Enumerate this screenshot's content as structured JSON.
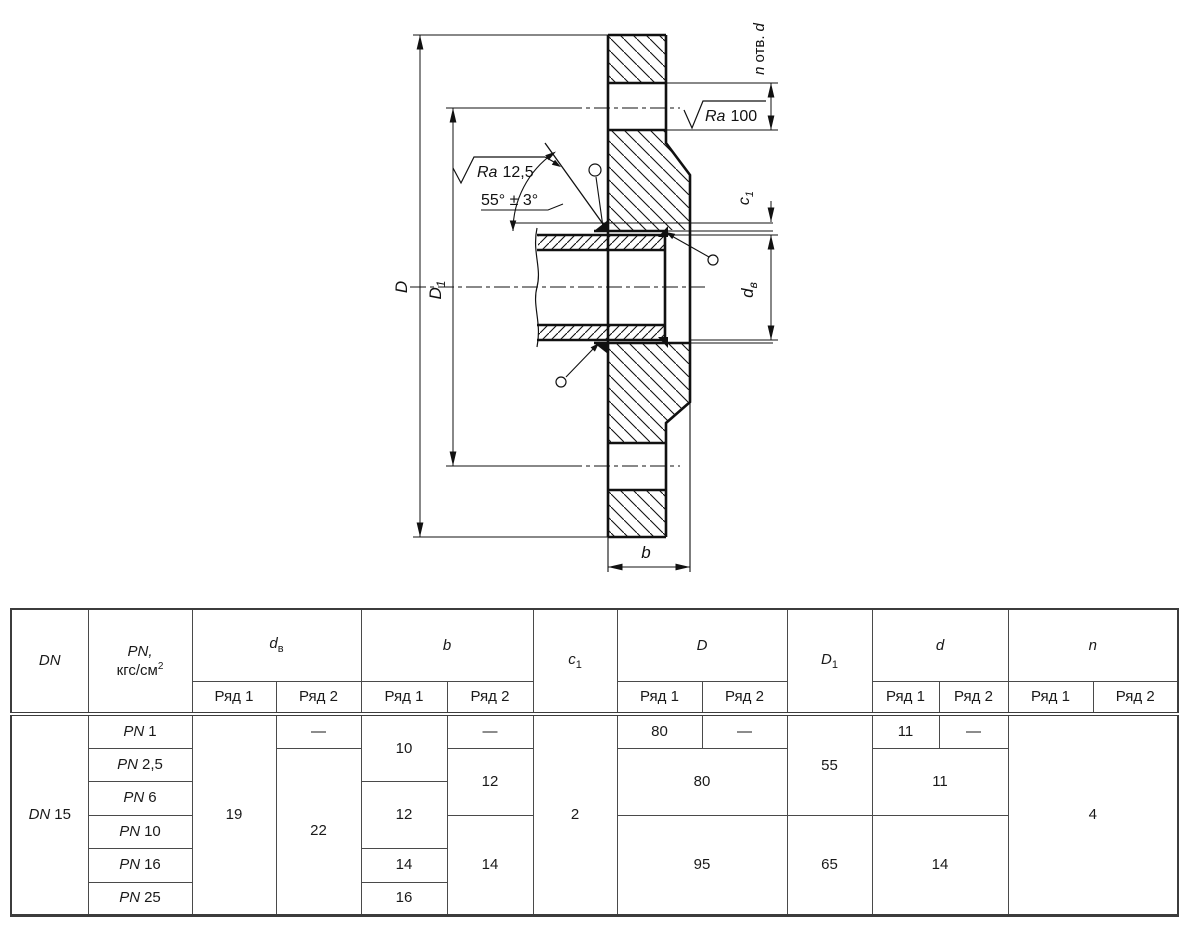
{
  "drawing": {
    "labels": {
      "D": "D",
      "D1_base": "D",
      "D1_sub": "1",
      "dv_base": "d",
      "dv_sub": "в",
      "c1_base": "c",
      "c1_sub": "1",
      "b": "b",
      "n_otv_prefix": "n",
      "n_otv_mid": "отв.",
      "n_otv_suffix": "d",
      "angle": "55° ± 3°",
      "ra_face_prefix": "Ra",
      "ra_face_value": "12,5",
      "ra_holes_prefix": "Ra",
      "ra_holes_value": "100"
    },
    "line_color": "#111111",
    "background": "#ffffff"
  },
  "table": {
    "headers": {
      "dn": "DN",
      "pn_line1": "PN,",
      "pn_unit": "кгс/см",
      "pn_sup": "2",
      "dv_base": "d",
      "dv_sub": "в",
      "b": "b",
      "c1_base": "c",
      "c1_sub": "1",
      "D": "D",
      "D1_base": "D",
      "D1_sub": "1",
      "d": "d",
      "n": "n",
      "row1": "Ряд 1",
      "row2": "Ряд 2"
    },
    "dn": {
      "label": "DN",
      "value": "15"
    },
    "rows": [
      {
        "pn_label": "PN",
        "pn": "1",
        "dv_r1": "19",
        "dv_r2": "—",
        "b_r1": "10",
        "b_r2": "—",
        "c1": "2",
        "D_r1": "80",
        "D_r2": "—",
        "D1": "55",
        "d_r1": "11",
        "d_r2": "—",
        "n": "4"
      },
      {
        "pn_label": "PN",
        "pn": "2,5",
        "dv_r2": "22",
        "b_r2": "12",
        "D": "80",
        "d": "11"
      },
      {
        "pn_label": "PN",
        "pn": "6",
        "b_r1": "12"
      },
      {
        "pn_label": "PN",
        "pn": "10",
        "b_r2": "14",
        "D": "95",
        "D1": "65",
        "d": "14"
      },
      {
        "pn_label": "PN",
        "pn": "16",
        "b_r1": "14"
      },
      {
        "pn_label": "PN",
        "pn": "25",
        "b_r1": "16"
      }
    ]
  }
}
